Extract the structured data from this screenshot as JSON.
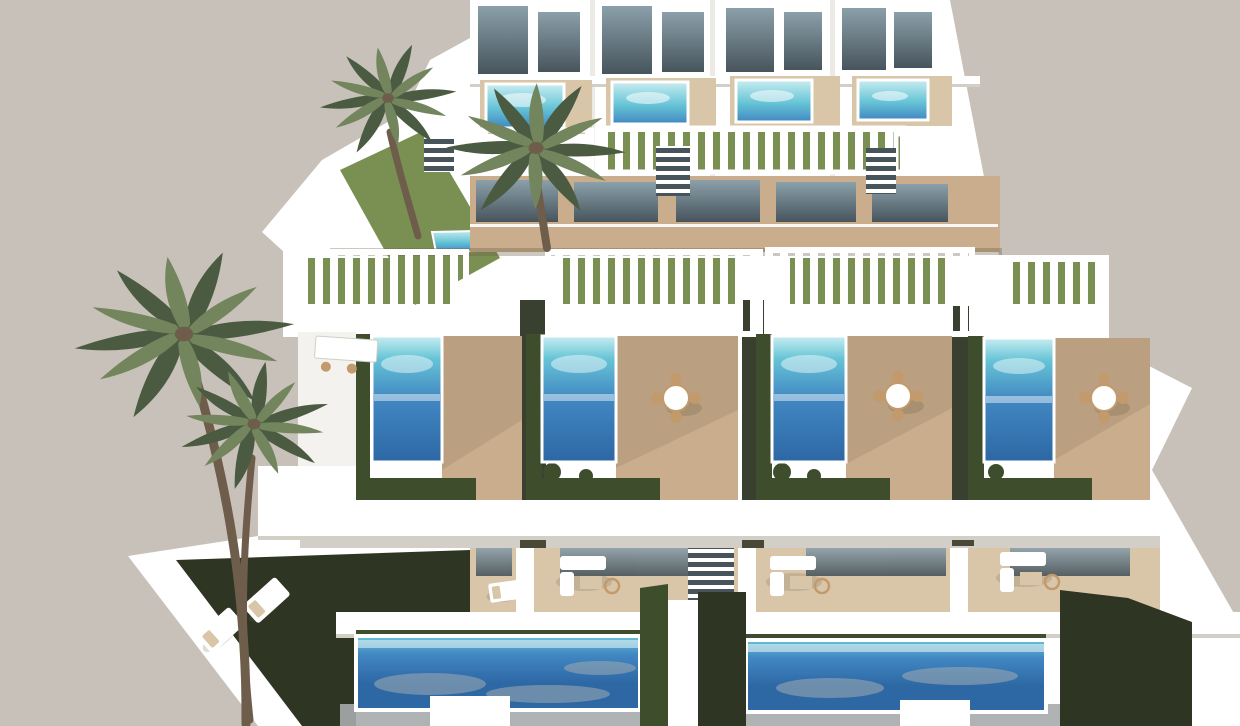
{
  "image": {
    "type": "architectural-3d-render",
    "description": "High-angle aerial 3D rendering of a terraced development of modern white villas. Each tier of units has private swimming pools, timber sun decks, white slatted pergolas, glass balustrades, trimmed hedges and artificial lawns. Tall palm trees stand at the left and top against a plain warm-grey sky. No text appears in the image.",
    "view": "aerial-oblique",
    "contains_text": false
  },
  "scene": {
    "sky": "plain warm grey, cloudless",
    "tiers": {
      "top_row": {
        "units": 4,
        "features": "rooftop plunge pools, slatted pergolas, glass facades, balconies, lawn strip, external stairs"
      },
      "middle_row": {
        "units": 4,
        "features": "private pools with hedge planters, timber decks, round rattan dining sets, slatted pergolas"
      },
      "bottom_row": {
        "units": 3,
        "features": "large ground pools, lounge terraces with white sofas, sun loungers on dark lawn"
      }
    },
    "counts": {
      "palm_trees": 4,
      "rooftop_pools": 4,
      "terrace_pools": 4,
      "ground_pools": 2,
      "pergolas": 7,
      "dining_sets": 3,
      "sofa_sets": 3,
      "sun_loungers": 2
    }
  },
  "colors": {
    "sky": "#c8c1b9",
    "white": "#ffffff",
    "slab_shade": "#eceae4",
    "shadow_grey": "#d2cfc7",
    "stone_grey": "#a7abac",
    "dark_gap": "#3a4030",
    "glass_dark": "#47545c",
    "glass_light": "#8ba0aa",
    "wood": "#c9ad8c",
    "wood_light": "#d9c6a9",
    "pool_deep": "#2d67a4",
    "pool_mid": "#4187c2",
    "pool_turquoise": "#66c4d6",
    "pool_pale": "#c9edf1",
    "pool_reflection": "#97a6b2",
    "turf": "#7a9053",
    "grass_dark": "#2e3522",
    "hedge": "#3e4e2d",
    "palm_dark": "#4a5b41",
    "palm_light": "#73855d",
    "trunk": "#6f5d4c",
    "wicker": "#c29a6c",
    "shadow_warm": "#6e5e49"
  }
}
